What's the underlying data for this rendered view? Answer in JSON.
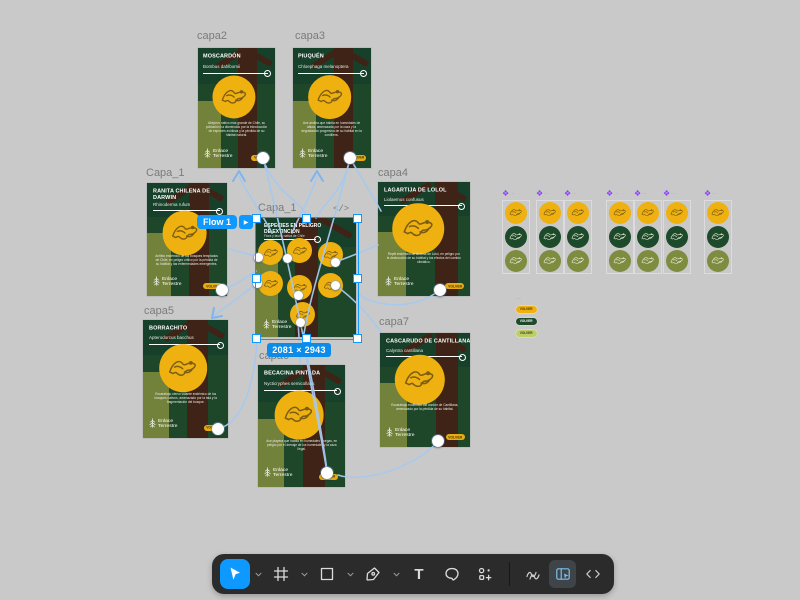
{
  "canvas": {
    "background": "#c9c9c9"
  },
  "logo": {
    "line1": "Enlace",
    "line2": "Terrestre"
  },
  "flow_badge": {
    "label": "Flow 1"
  },
  "selection": {
    "dimensions": "2081 × 2943",
    "dev_icon": "</>"
  },
  "menu": {
    "label": "Capa_1",
    "title_line1": "ESPECIES EN PELIGRO",
    "title_line2": "DE EXTINCIÓN",
    "subtitle": "Flora y fauna nativa de Chile"
  },
  "frames": {
    "capa2": {
      "label": "capa2",
      "title": "MOSCARDÓN",
      "species": "Bombus dahlbomii",
      "description": "Abejorro nativo más grande de Chile, su población ha disminuido por la introducción de especies exóticas y la pérdida de su hábitat natural.",
      "button": "VOLVER"
    },
    "capa3": {
      "label": "capa3",
      "title": "PIUQUÉN",
      "species": "Chloephaga melanoptera",
      "description": "Ave andina que habita en humedales de altura, amenazada por la caza y la degradación progresiva de su hábitat en la cordillera.",
      "button": "VOLVER"
    },
    "capa1_left": {
      "label": "Capa_1",
      "title": "RANITA CHILENA DE DARWIN",
      "species": "Rhinoderma rufum",
      "description": "Anfibio endémico de los bosques templados de Chile, en peligro crítico por la pérdida de su hábitat y las enfermedades emergentes.",
      "button": "VOLVER"
    },
    "capa4": {
      "label": "capa4",
      "title": "LAGARTIJA DE LOLOL",
      "species": "Liolaemus confusus",
      "description": "Reptil endémico de la zona de Lolol, en peligro por la destrucción de su hábitat y los efectos del cambio climático.",
      "button": "VOLVER"
    },
    "capa5": {
      "label": "capa5",
      "title": "BORRACHITO",
      "species": "Apterodorcus bacchus",
      "description": "Escarabajo ciervo volante endémico de los bosques nativos, amenazado por la tala y la fragmentación del bosque.",
      "button": "VOLVER"
    },
    "capa6": {
      "label": "capa6",
      "title": "BECACINA PINTADA",
      "species": "Nycticryphes semicollaris",
      "description": "Ave playera que habita en humedales y vegas, en peligro por el drenaje de los humedales y la caza ilegal.",
      "button": "VOLVER"
    },
    "capa7": {
      "label": "capa7",
      "title": "CASCARUDO DE CANTILLANA",
      "species": "Calyntra cantillana",
      "description": "Escarabajo endémico del cordón de Cantillana, amenazado por la pérdida de su hábitat.",
      "button": "VOLVER"
    }
  },
  "components": {
    "set_labels": [
      "···",
      "···",
      "···",
      "···",
      "···",
      "···",
      "···"
    ],
    "pill_group_label": "···",
    "pills": [
      {
        "label": "VOLVER",
        "variant": "yellow"
      },
      {
        "label": "VOLVER",
        "variant": "dark-green"
      },
      {
        "label": "VOLVER",
        "variant": "light-green"
      }
    ],
    "colors": {
      "yellow": "#efb10f",
      "dark_green": "#1d4a2b",
      "olive": "#7e8c3f",
      "purple": "#8b3dff"
    }
  },
  "toolbar": {
    "tools": [
      {
        "name": "move",
        "active": true
      },
      {
        "name": "frame",
        "active": false
      },
      {
        "name": "shape",
        "active": false
      },
      {
        "name": "pen",
        "active": false
      },
      {
        "name": "text",
        "active": false
      },
      {
        "name": "comment",
        "active": false
      },
      {
        "name": "actions",
        "active": false
      }
    ],
    "modes": [
      {
        "name": "draw",
        "active": false
      },
      {
        "name": "inspect",
        "active": true
      },
      {
        "name": "dev-code",
        "active": false
      }
    ]
  },
  "ui_colors": {
    "selection_blue": "#0d99ff",
    "noodle_blue": "#a6c9ef",
    "poster_green": "#1e4629"
  }
}
